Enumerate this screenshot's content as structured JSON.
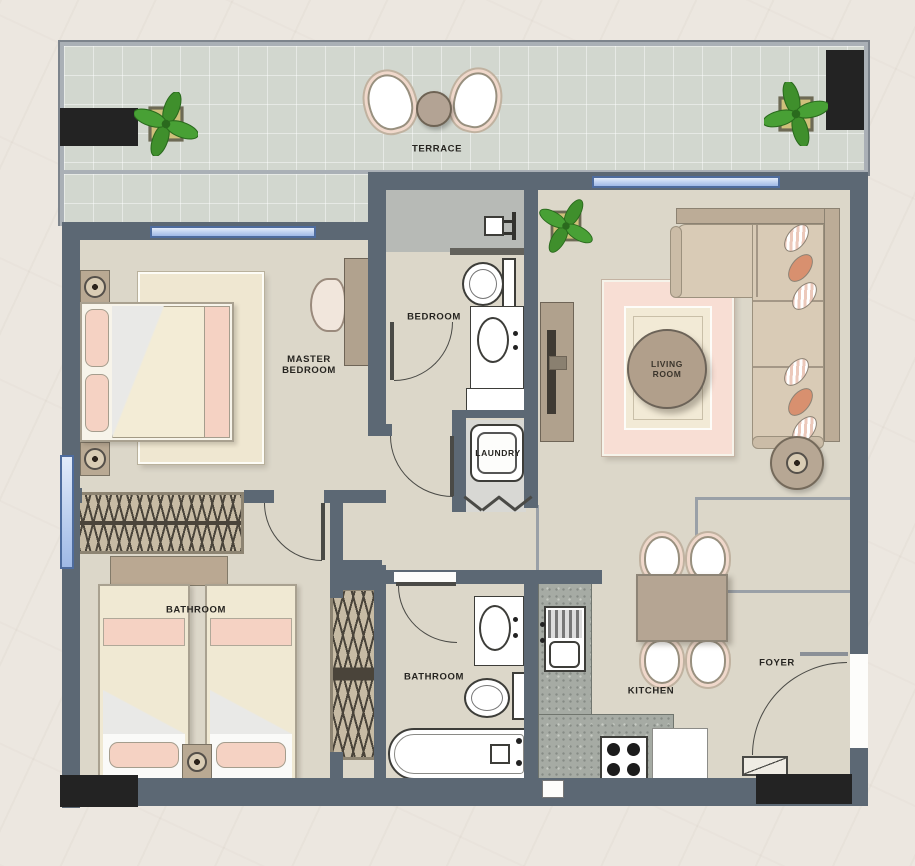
{
  "rooms": {
    "terrace": {
      "label": "TERRACE"
    },
    "master_bedroom": {
      "label_line1": "MASTER",
      "label_line2": "BEDROOM"
    },
    "bedroom": {
      "label": "BEDROOM"
    },
    "laundry": {
      "label": "LAUNDRY"
    },
    "living_room": {
      "label_line1": "LIVING",
      "label_line2": "ROOM"
    },
    "bedroom2": {
      "label": "BATHROOM"
    },
    "bathroom": {
      "label": "BATHROOM"
    },
    "kitchen": {
      "label": "KITCHEN"
    },
    "foyer": {
      "label": "FOYER"
    }
  },
  "colors": {
    "wall": "#5c6874",
    "floor": "#dcd7c9",
    "terrace_floor": "#d2d7cf",
    "window_blue": "#c7d7f2",
    "accent_pink": "#f5d2c3",
    "sofa_tan": "#d6c7b2",
    "wood_brown": "#b2a290",
    "granite": "#a6aba4",
    "column_black": "#232323",
    "plant_green": "#3f8f2c",
    "page_background": "#ece7e0"
  }
}
